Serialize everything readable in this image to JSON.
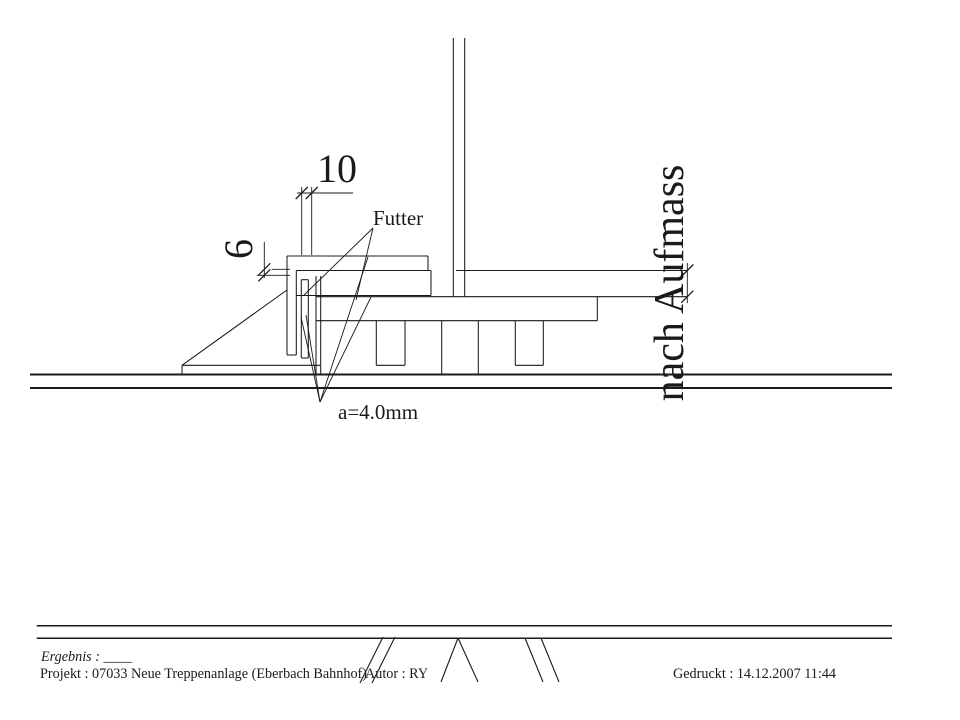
{
  "sheet": {
    "width": 960,
    "height": 720,
    "background": "#ffffff",
    "ink": "#1a1a1a"
  },
  "labels": {
    "dim_top": "10",
    "dim_side": "6",
    "shim": "Futter",
    "weld": "a=4.0mm",
    "site_measure": "nach Aufmass"
  },
  "footer": {
    "result": "Ergebnis : ____",
    "project": "Projekt : 07033  Neue Treppenanlage (Eberbach Bahnhof)",
    "author": "Autor : RY",
    "printed": "Gedruckt : 14.12.2007  11:44"
  },
  "geometry": {
    "structure_lines": [
      {
        "n": "post-left-edge",
        "p": [
          453.3,
          38,
          453.3,
          296.7
        ]
      },
      {
        "n": "post-right-edge",
        "p": [
          464.7,
          38,
          464.7,
          296.7
        ]
      },
      {
        "n": "top-plate-top",
        "p": [
          287,
          256,
          428,
          256
        ]
      },
      {
        "n": "top-plate-right",
        "p": [
          428,
          256,
          428,
          270.5
        ]
      },
      {
        "n": "shim-plate1-seam",
        "p": [
          296.3,
          270.5,
          431,
          270.5
        ]
      },
      {
        "n": "right-plate-top",
        "p": [
          456,
          270.5,
          687.3,
          270.5
        ]
      },
      {
        "n": "angle-outer-edge",
        "p": [
          287,
          256,
          287,
          355
        ]
      },
      {
        "n": "angle-inner-edge",
        "p": [
          296.3,
          270.5,
          296.3,
          355
        ]
      },
      {
        "n": "angle-bottom",
        "p": [
          287,
          355,
          296.3,
          355
        ]
      },
      {
        "n": "shim-plate2-bottom",
        "p": [
          296.3,
          295.5,
          431,
          295.5
        ]
      },
      {
        "n": "shim-plate2-right",
        "p": [
          431,
          270.5,
          431,
          295.5
        ]
      },
      {
        "n": "vertical-shim-left",
        "p": [
          301.3,
          279.7,
          301.3,
          358
        ]
      },
      {
        "n": "vertical-shim-right",
        "p": [
          308.3,
          279.7,
          308.3,
          358
        ]
      },
      {
        "n": "vertical-shim-top",
        "p": [
          301.3,
          279.7,
          308.3,
          279.7
        ]
      },
      {
        "n": "vertical-shim-bottom",
        "p": [
          301.3,
          358,
          308.3,
          358
        ]
      },
      {
        "n": "base-plate-top-edge",
        "p": [
          316,
          296.7,
          687.3,
          296.7
        ]
      },
      {
        "n": "base-plate-bottom-edge",
        "p": [
          316,
          320.7,
          597.3,
          320.7
        ]
      },
      {
        "n": "base-plate-right-edge",
        "p": [
          597.3,
          296.7,
          597.3,
          320.7
        ]
      },
      {
        "n": "web-plate-left",
        "p": [
          316,
          276,
          316,
          374.5
        ]
      },
      {
        "n": "web-plate-right",
        "p": [
          320.7,
          276,
          320.7,
          374.5
        ]
      },
      {
        "n": "anchor-tab1-left",
        "p": [
          376.3,
          320.7,
          376.3,
          365.3
        ]
      },
      {
        "n": "anchor-tab1-right",
        "p": [
          405,
          320.7,
          405,
          365.3
        ]
      },
      {
        "n": "anchor-tab1-bottom",
        "p": [
          376.3,
          365.3,
          405,
          365.3
        ]
      },
      {
        "n": "anchor-tab2-left",
        "p": [
          515.3,
          320.7,
          515.3,
          365.3
        ]
      },
      {
        "n": "anchor-tab2-right",
        "p": [
          543.3,
          320.7,
          543.3,
          365.3
        ]
      },
      {
        "n": "anchor-tab2-bottom",
        "p": [
          515.3,
          365.3,
          543.3,
          365.3
        ]
      },
      {
        "n": "anchor-block-left",
        "p": [
          441.7,
          320.7,
          441.7,
          374.5
        ]
      },
      {
        "n": "anchor-block-right",
        "p": [
          478.3,
          320.7,
          478.3,
          374.5
        ]
      },
      {
        "n": "sole-plate-top",
        "p": [
          182,
          365.3,
          320,
          365.3
        ]
      },
      {
        "n": "sole-plate-left",
        "p": [
          182,
          365.3,
          182,
          374.5
        ]
      },
      {
        "n": "gusset-hypotenuse",
        "p": [
          182,
          365.3,
          287,
          290
        ]
      }
    ],
    "ground_lines": [
      {
        "n": "ground-line-upper",
        "p": [
          30,
          374.5,
          892,
          374.5
        ]
      },
      {
        "n": "ground-line-lower",
        "p": [
          30,
          388,
          892,
          388
        ]
      }
    ],
    "dim_lines": [
      {
        "n": "dim10-line",
        "p": [
          297,
          193,
          353,
          193
        ]
      },
      {
        "n": "dim10-ext-left",
        "p": [
          301.7,
          187,
          301.7,
          255
        ]
      },
      {
        "n": "dim10-ext-right",
        "p": [
          311.7,
          187,
          311.7,
          255
        ]
      },
      {
        "n": "dim6-line",
        "p": [
          264.3,
          241.7,
          264.3,
          278
        ]
      },
      {
        "n": "dim6-ext-upper",
        "p": [
          271.7,
          269.3,
          290,
          269.3
        ]
      },
      {
        "n": "dim6-ext-lower",
        "p": [
          256.7,
          275.3,
          290,
          275.3
        ]
      },
      {
        "n": "aufmass-dim-line",
        "p": [
          687.3,
          263,
          687.3,
          303
        ]
      }
    ],
    "ticks": [
      {
        "n": "tick-dim10-left",
        "x": 301.7,
        "y": 193
      },
      {
        "n": "tick-dim10-right",
        "x": 311.7,
        "y": 193
      },
      {
        "n": "tick-dim6-upper",
        "x": 264.3,
        "y": 269.3
      },
      {
        "n": "tick-dim6-lower",
        "x": 264.3,
        "y": 275.3
      },
      {
        "n": "tick-aufmass-top",
        "x": 687.3,
        "y": 270.5
      },
      {
        "n": "tick-aufmass-bottom",
        "x": 687.3,
        "y": 296.7
      }
    ],
    "leader_lines": [
      {
        "n": "futter-leader-1",
        "p": [
          373,
          228,
          303,
          296
        ]
      },
      {
        "n": "futter-leader-2",
        "p": [
          373,
          228,
          356,
          300
        ]
      },
      {
        "n": "weld-leader-1",
        "p": [
          320,
          402,
          301,
          317
        ]
      },
      {
        "n": "weld-leader-2",
        "p": [
          320,
          402,
          306,
          315
        ]
      },
      {
        "n": "weld-leader-3",
        "p": [
          320,
          402,
          368,
          257
        ]
      },
      {
        "n": "weld-leader-4",
        "p": [
          320,
          402,
          371,
          297
        ]
      }
    ],
    "footer_rules": [
      {
        "n": "footer-rule-upper",
        "p": [
          36.7,
          625.7,
          892,
          625.7
        ]
      },
      {
        "n": "footer-rule-lower",
        "p": [
          36.7,
          638.3,
          892,
          638.3
        ]
      }
    ],
    "break_marks": [
      {
        "n": "break-mark-slash1",
        "p": [
          360,
          683,
          383,
          637
        ]
      },
      {
        "n": "break-mark-slash2",
        "p": [
          372,
          683,
          395,
          637
        ]
      },
      {
        "n": "break-mark-vee-left",
        "p": [
          458,
          638,
          441,
          682
        ]
      },
      {
        "n": "break-mark-vee-right",
        "p": [
          458,
          638,
          478,
          682
        ]
      },
      {
        "n": "break-mark-backslash1",
        "p": [
          525,
          638,
          543,
          682
        ]
      },
      {
        "n": "break-mark-backslash2",
        "p": [
          541,
          638,
          559,
          682
        ]
      }
    ],
    "texts": [
      {
        "n": "dim-top-label",
        "key": "labels.dim_top",
        "x": 337,
        "y": 182,
        "size": 40,
        "anchor": "middle"
      },
      {
        "n": "dim-side-label",
        "key": "labels.dim_side",
        "x": 252,
        "y": 249,
        "size": 40,
        "anchor": "middle",
        "rotate": -90
      },
      {
        "n": "shim-label",
        "key": "labels.shim",
        "x": 373,
        "y": 225,
        "size": 21,
        "anchor": "start"
      },
      {
        "n": "weld-label",
        "key": "labels.weld",
        "x": 338,
        "y": 419,
        "size": 21,
        "anchor": "start"
      },
      {
        "n": "site-measure-label",
        "key": "labels.site_measure",
        "x": 683,
        "y": 283,
        "size": 42,
        "anchor": "middle",
        "rotate": -90
      },
      {
        "n": "footer-result-label",
        "key": "footer.result",
        "x": 41,
        "y": 661,
        "size": 14.2,
        "anchor": "start",
        "italic": true
      },
      {
        "n": "footer-project-label",
        "key": "footer.project",
        "x": 40,
        "y": 678,
        "size": 14.2,
        "anchor": "start"
      },
      {
        "n": "footer-author-label",
        "key": "footer.author",
        "x": 365,
        "y": 678,
        "size": 14.2,
        "anchor": "start"
      },
      {
        "n": "footer-printed-label",
        "key": "footer.printed",
        "x": 673,
        "y": 678,
        "size": 14.2,
        "anchor": "start"
      }
    ]
  }
}
